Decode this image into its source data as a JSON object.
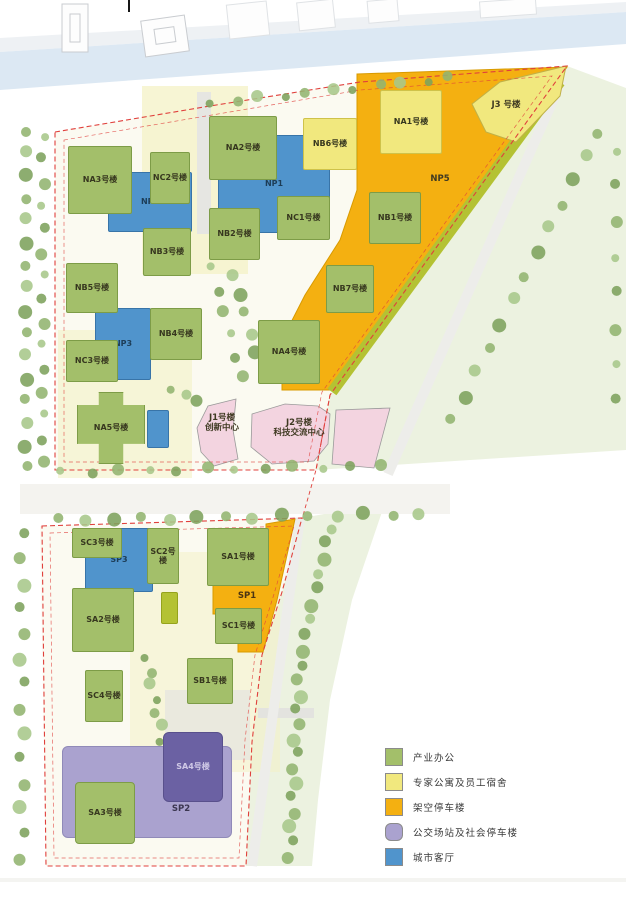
{
  "b": {
    "na1": "NA1号楼",
    "na2": "NA2号楼",
    "na3": "NA3号楼",
    "na4": "NA4号楼",
    "na5": "NA5号楼",
    "nb1": "NB1号楼",
    "nb2": "NB2号楼",
    "nb3": "NB3号楼",
    "nb4": "NB4号楼",
    "nb5": "NB5号楼",
    "nb6": "NB6号楼",
    "nb7": "NB7号楼",
    "nc1": "NC1号楼",
    "nc2": "NC2号楼",
    "nc3": "NC3号楼",
    "np1": "NP1",
    "np2": "NP2",
    "np3": "NP3",
    "np5": "NP5",
    "j1": "J1号楼",
    "j1sub": "创新中心",
    "j2": "J2号楼",
    "j2sub": "科技交流中心",
    "j3": "J3 号楼",
    "sa1": "SA1号楼",
    "sa2": "SA2号楼",
    "sa3": "SA3号楼",
    "sa4": "SA4号楼",
    "sb1": "SB1号楼",
    "sc1": "SC1号楼",
    "sc2": "SC2号楼",
    "sc3": "SC3号楼",
    "sc4": "SC4号楼",
    "sp1": "SP1",
    "sp2": "SP2",
    "sp3": "SP3"
  },
  "legend": {
    "items": [
      {
        "label": "产业办公",
        "color": "#a3bf6a"
      },
      {
        "label": "专家公寓及员工宿舍",
        "color": "#f1e87e"
      },
      {
        "label": "架空停车楼",
        "color": "#f4b011"
      },
      {
        "label": "公交场站及社会停车楼",
        "color": "#aaa2cf"
      },
      {
        "label": "城市客厅",
        "color": "#5094cc"
      }
    ]
  },
  "colors": {
    "site_ground": "#fbfaf1",
    "lawn": "#ecf2e0",
    "river": "#dce8f3",
    "boundary_red": "#e0403c",
    "pink_building": "#f3d4e0",
    "olive_strip": "#b4c233"
  }
}
